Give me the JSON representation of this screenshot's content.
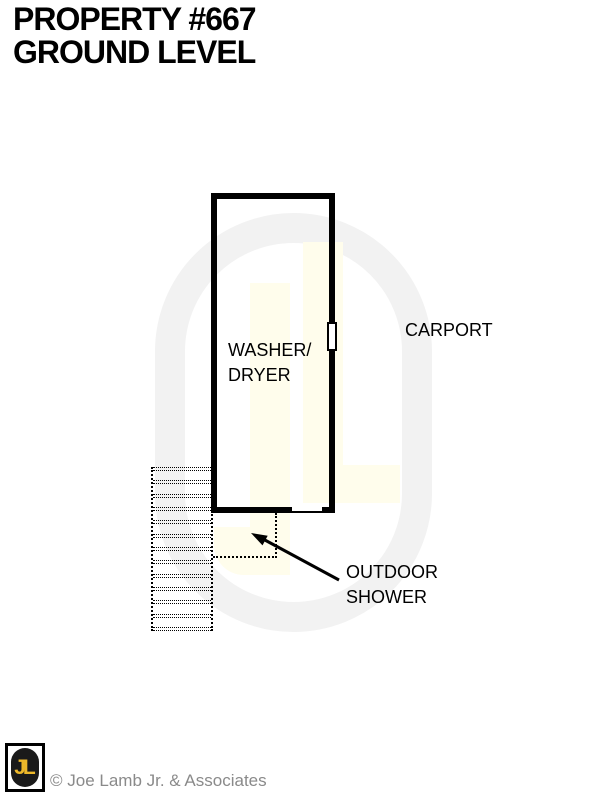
{
  "title": {
    "line1": "PROPERTY #667",
    "line2": "GROUND LEVEL"
  },
  "rooms": {
    "washer_dryer": {
      "line1": "WASHER/",
      "line2": "DRYER"
    },
    "carport": "CARPORT",
    "outdoor_shower": {
      "line1": "OUTDOOR",
      "line2": "SHOWER"
    }
  },
  "stairs": {
    "steps": 13
  },
  "footer": {
    "logo_text": "JL",
    "copyright": "© Joe Lamb Jr. & Associates"
  },
  "colors": {
    "wall": "#000000",
    "watermark-cream": "#FFFDEC",
    "watermark-ring": "#F2F2F2",
    "logo-yellow": "#EDB82A",
    "logo-black": "#1A1A1A",
    "copyright-gray": "#8A8A8A"
  }
}
